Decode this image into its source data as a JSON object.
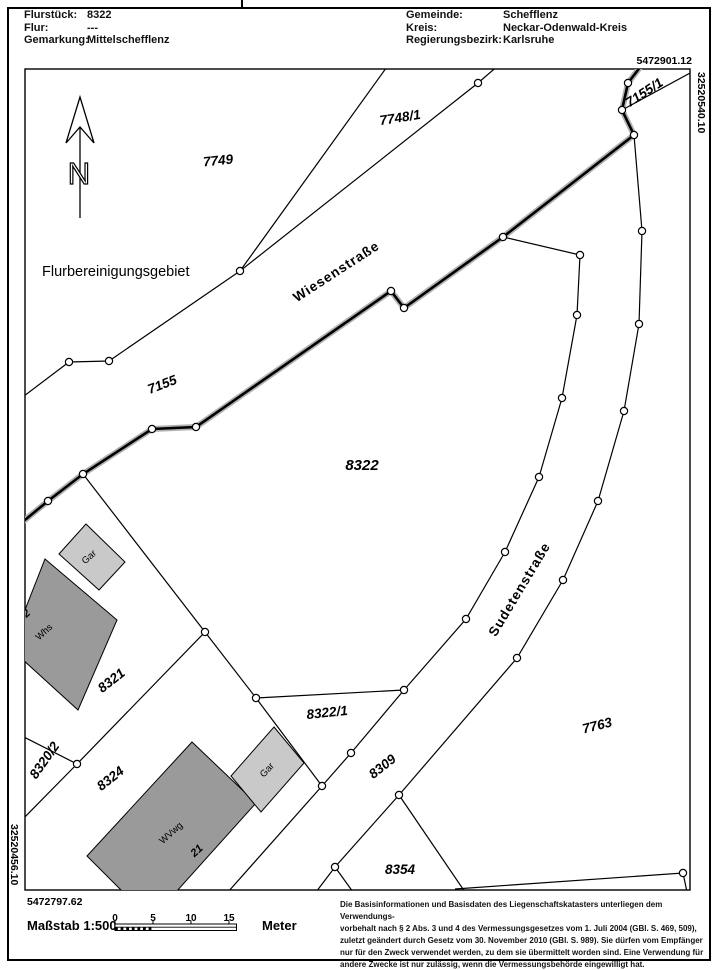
{
  "header": {
    "left": [
      {
        "label": "Flurstück:",
        "value": "8322"
      },
      {
        "label": "Flur:",
        "value": "---"
      },
      {
        "label": "Gemarkung:",
        "value": "Mittelschefflenz"
      }
    ],
    "right": [
      {
        "label": "Gemeinde:",
        "value": "Schefflenz"
      },
      {
        "label": "Kreis:",
        "value": "Neckar-Odenwald-Kreis"
      },
      {
        "label": "Regierungsbezirk:",
        "value": "Karlsruhe"
      }
    ]
  },
  "coordinates": {
    "top_right_northing": "5472901.12",
    "top_right_easting": "32520540.10",
    "bottom_left_easting": "32520456.10",
    "bottom_left_northing": "5472797.62"
  },
  "map": {
    "region_label": "Flurbereinigungsgebiet",
    "north_arrow_letter": "N",
    "parcels": {
      "p7749": "7749",
      "p7748_1": "7748/1",
      "p7155": "7155",
      "p7155_1": "7155/1",
      "p8322": "8322",
      "p8321": "8321",
      "p8320_2": "8320/2",
      "p8324": "8324",
      "p8322_1": "8322/1",
      "p8309": "8309",
      "p8354": "8354",
      "p7763": "7763"
    },
    "streets": {
      "wiesenstrasse": "Wiesenstraße",
      "sudetenstrasse": "Sudetenstraße"
    },
    "buildings": {
      "gar1": "Gar",
      "whs": "Whs",
      "house2": "2",
      "gar2": "Gar",
      "wvwg": "WVwg",
      "num21": "21"
    }
  },
  "footer": {
    "scale_label": "Maßstab 1:500",
    "scale_ticks": [
      "0",
      "5",
      "10",
      "15"
    ],
    "unit": "Meter",
    "legal": [
      "Die Basisinformationen und Basisdaten des Liegenschaftskatasters unterliegen dem Verwendungs-",
      "vorbehalt nach § 2 Abs. 3 und 4 des Vermessungsgesetzes vom 1. Juli 2004 (GBl. S. 469, 509),",
      "zuletzt geändert durch Gesetz vom 30. November 2010 (GBl. S. 989). Sie dürfen vom Empfänger",
      "nur für den Zweck verwendet werden, zu dem sie übermittelt worden sind. Eine Verwendung für",
      "andere Zwecke ist nur zulässig, wenn die Vermessungsbehörde eingewilligt hat."
    ]
  },
  "colors": {
    "line": "#000000",
    "halo": "#b0b0b0",
    "building_dark": "#9a9a9a",
    "building_light": "#c9c9c9"
  }
}
